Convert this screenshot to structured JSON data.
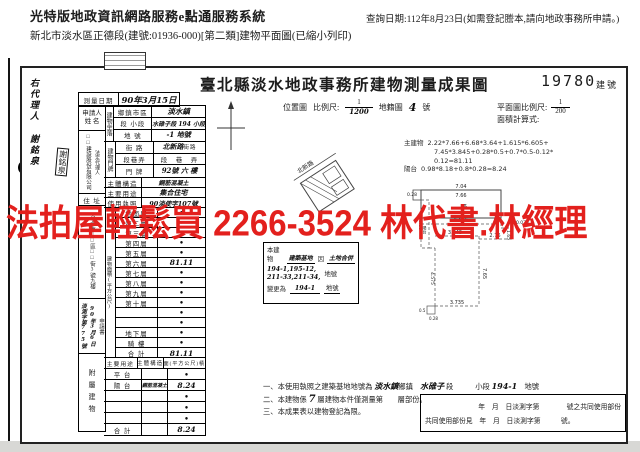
{
  "header": {
    "system_title": "光特版地政資訊網路服務e點通服務系統",
    "doc_line": "新北市淡水區正德段(建號:01936-000)[第二類]建物平面圖(已縮小列印)",
    "query_date": "查詢日期:112年8月23日(如需登記謄本,請向地政事務所申請。)"
  },
  "ad": {
    "text": "法拍屋輕鬆買 2266-3524 林代書.林經理",
    "color": "#e3201d"
  },
  "doc": {
    "title": "臺北縣淡水地政事務所建物測量成果圖",
    "building_no": "19780",
    "building_no_unit": "建號",
    "margin_agent": "右代理人 謝銘泉",
    "seal": "謝銘泉",
    "survey": {
      "label": "測量日期",
      "value": "90年3月15日"
    },
    "applicant": {
      "section": "申請人",
      "name_label": "姓 名",
      "name_text": "□□建設股份有限公司",
      "name_text2": "法定代理人",
      "addr_label": "住 址",
      "addr_text": "台北市□□區□□街3號九樓"
    },
    "receipt": {
      "doc_label": "申請書",
      "date": "90年3月6日",
      "office": "淡測",
      "no_label": "字第",
      "no": "775",
      "no_unit": "號"
    },
    "site": {
      "vlabel": "建物坐落",
      "r1_label": "鄉鎮市區",
      "r1_value": "淡水鎮",
      "r2_label": "段 小段",
      "r2_value": "水碓子段 194 小段",
      "r3_label": "地 號",
      "r3_value": "-1 地號"
    },
    "door": {
      "vlabel": "建物門牌",
      "r1_label": "街 路",
      "r1_value": "北新路",
      "r1_suffix": "街路",
      "r2_label": "段巷弄",
      "r2_value": "段　巷　弄",
      "r3_label": "門 牌",
      "r3_value": "92號 六 樓"
    },
    "structure": {
      "label": "主體構造",
      "value": "鋼筋混凝土"
    },
    "usage": {
      "label": "主要用途",
      "value": "集合住宅"
    },
    "license": {
      "label": "使用執照",
      "value": "90淡使字107號"
    },
    "floor_area": {
      "vlabel": "建物面積(平方公尺)",
      "rows": [
        [
          "地面層",
          "•"
        ],
        [
          "第二層",
          "•"
        ],
        [
          "第三層",
          "•"
        ],
        [
          "第四層",
          "•"
        ],
        [
          "第五層",
          "•"
        ],
        [
          "第六層",
          "81.11"
        ],
        [
          "第七層",
          "•"
        ],
        [
          "第八層",
          "•"
        ],
        [
          "第九層",
          "•"
        ],
        [
          "第十層",
          "•"
        ],
        [
          "",
          "•"
        ],
        [
          "",
          "•"
        ],
        [
          "地下層",
          "•"
        ],
        [
          "騎 樓",
          "•"
        ],
        [
          "合 計",
          "81.11"
        ]
      ]
    },
    "attached": {
      "vlabel": "附屬建物",
      "header": [
        "主要用途",
        "主體構造",
        "面(平方公尺)積"
      ],
      "rows": [
        [
          "平 台",
          "",
          "•"
        ],
        [
          "陽 台",
          "鋼筋混凝土",
          "8.24"
        ],
        [
          "",
          "",
          "•"
        ],
        [
          "",
          "",
          "•"
        ],
        [
          "",
          "",
          "•"
        ],
        [
          "合 計",
          "",
          "8.24"
        ]
      ]
    },
    "map_row": {
      "loc_label": "位置圖",
      "scale_label": "比例尺:",
      "scale_num": "1",
      "scale_den": "1200",
      "cad_label": "地籍圖",
      "sheet": "4",
      "sheet_unit": "號",
      "plan_scale_label": "平面圖比例尺:",
      "plan_num": "1",
      "plan_den": "200",
      "calc_label": "面積計算式:"
    },
    "calc": {
      "main_label": "主建物",
      "line1": "2.22*7.66+6.68*3.64+1.615*6.605+",
      "line2": "7.45*3.845+0.28*0.5+0.7*0.5-0.12*",
      "line3": "0.12=81.11",
      "balcony_label": "陽台",
      "balcony_line": "0.98*8.18+0.8*0.28=8.24"
    },
    "merge": {
      "p1": "本建物",
      "p2": "建築基地",
      "p3": "因",
      "p4": "土地合併",
      "l2": "194-1,195-12,",
      "l3": "211-33,211-34,",
      "l3_suffix": "地號",
      "p5": "變更為",
      "v": "194-1",
      "suffix": "地號"
    },
    "plan": {
      "room": "6",
      "balcony": "陽台",
      "road": "北新路",
      "dims": {
        "top_outer": "7.04",
        "top_inner": "7.66",
        "notch": "0.28",
        "mid": "6.605",
        "step": "0.075",
        "step_v": "1.65",
        "inner": "3.845",
        "right_mid": "2.76",
        "right_v": "7.65",
        "left_v": "8.18",
        "left_low_v": "4.575",
        "bottom": "3.735",
        "corner_w": "0.5",
        "corner_h": "0.28"
      }
    },
    "notes": {
      "n1": "一、",
      "n1_p1": "本使用執照之建築基地地號為",
      "n1_h1": "淡水鎮",
      "n1_p2": "鄉鎮",
      "n1_h2": "水碓子",
      "n1_p3": "段",
      "n1_p4": "小段",
      "n1_h3": "194-1",
      "n1_p5": "地號",
      "n2": "二、",
      "n2_p1": "本建物係",
      "n2_h1": "7",
      "n2_p2": "層建物本件僅測量第",
      "n2_p3": "層部份。",
      "n3": "三、",
      "n3_text": "本成果表以建物登記為限。"
    },
    "common": {
      "line1": "年　月　日淡測字第　　　　號之共同使用部份",
      "line2": "共同使用部份見　年　月　日淡測字第　　　號。"
    }
  }
}
